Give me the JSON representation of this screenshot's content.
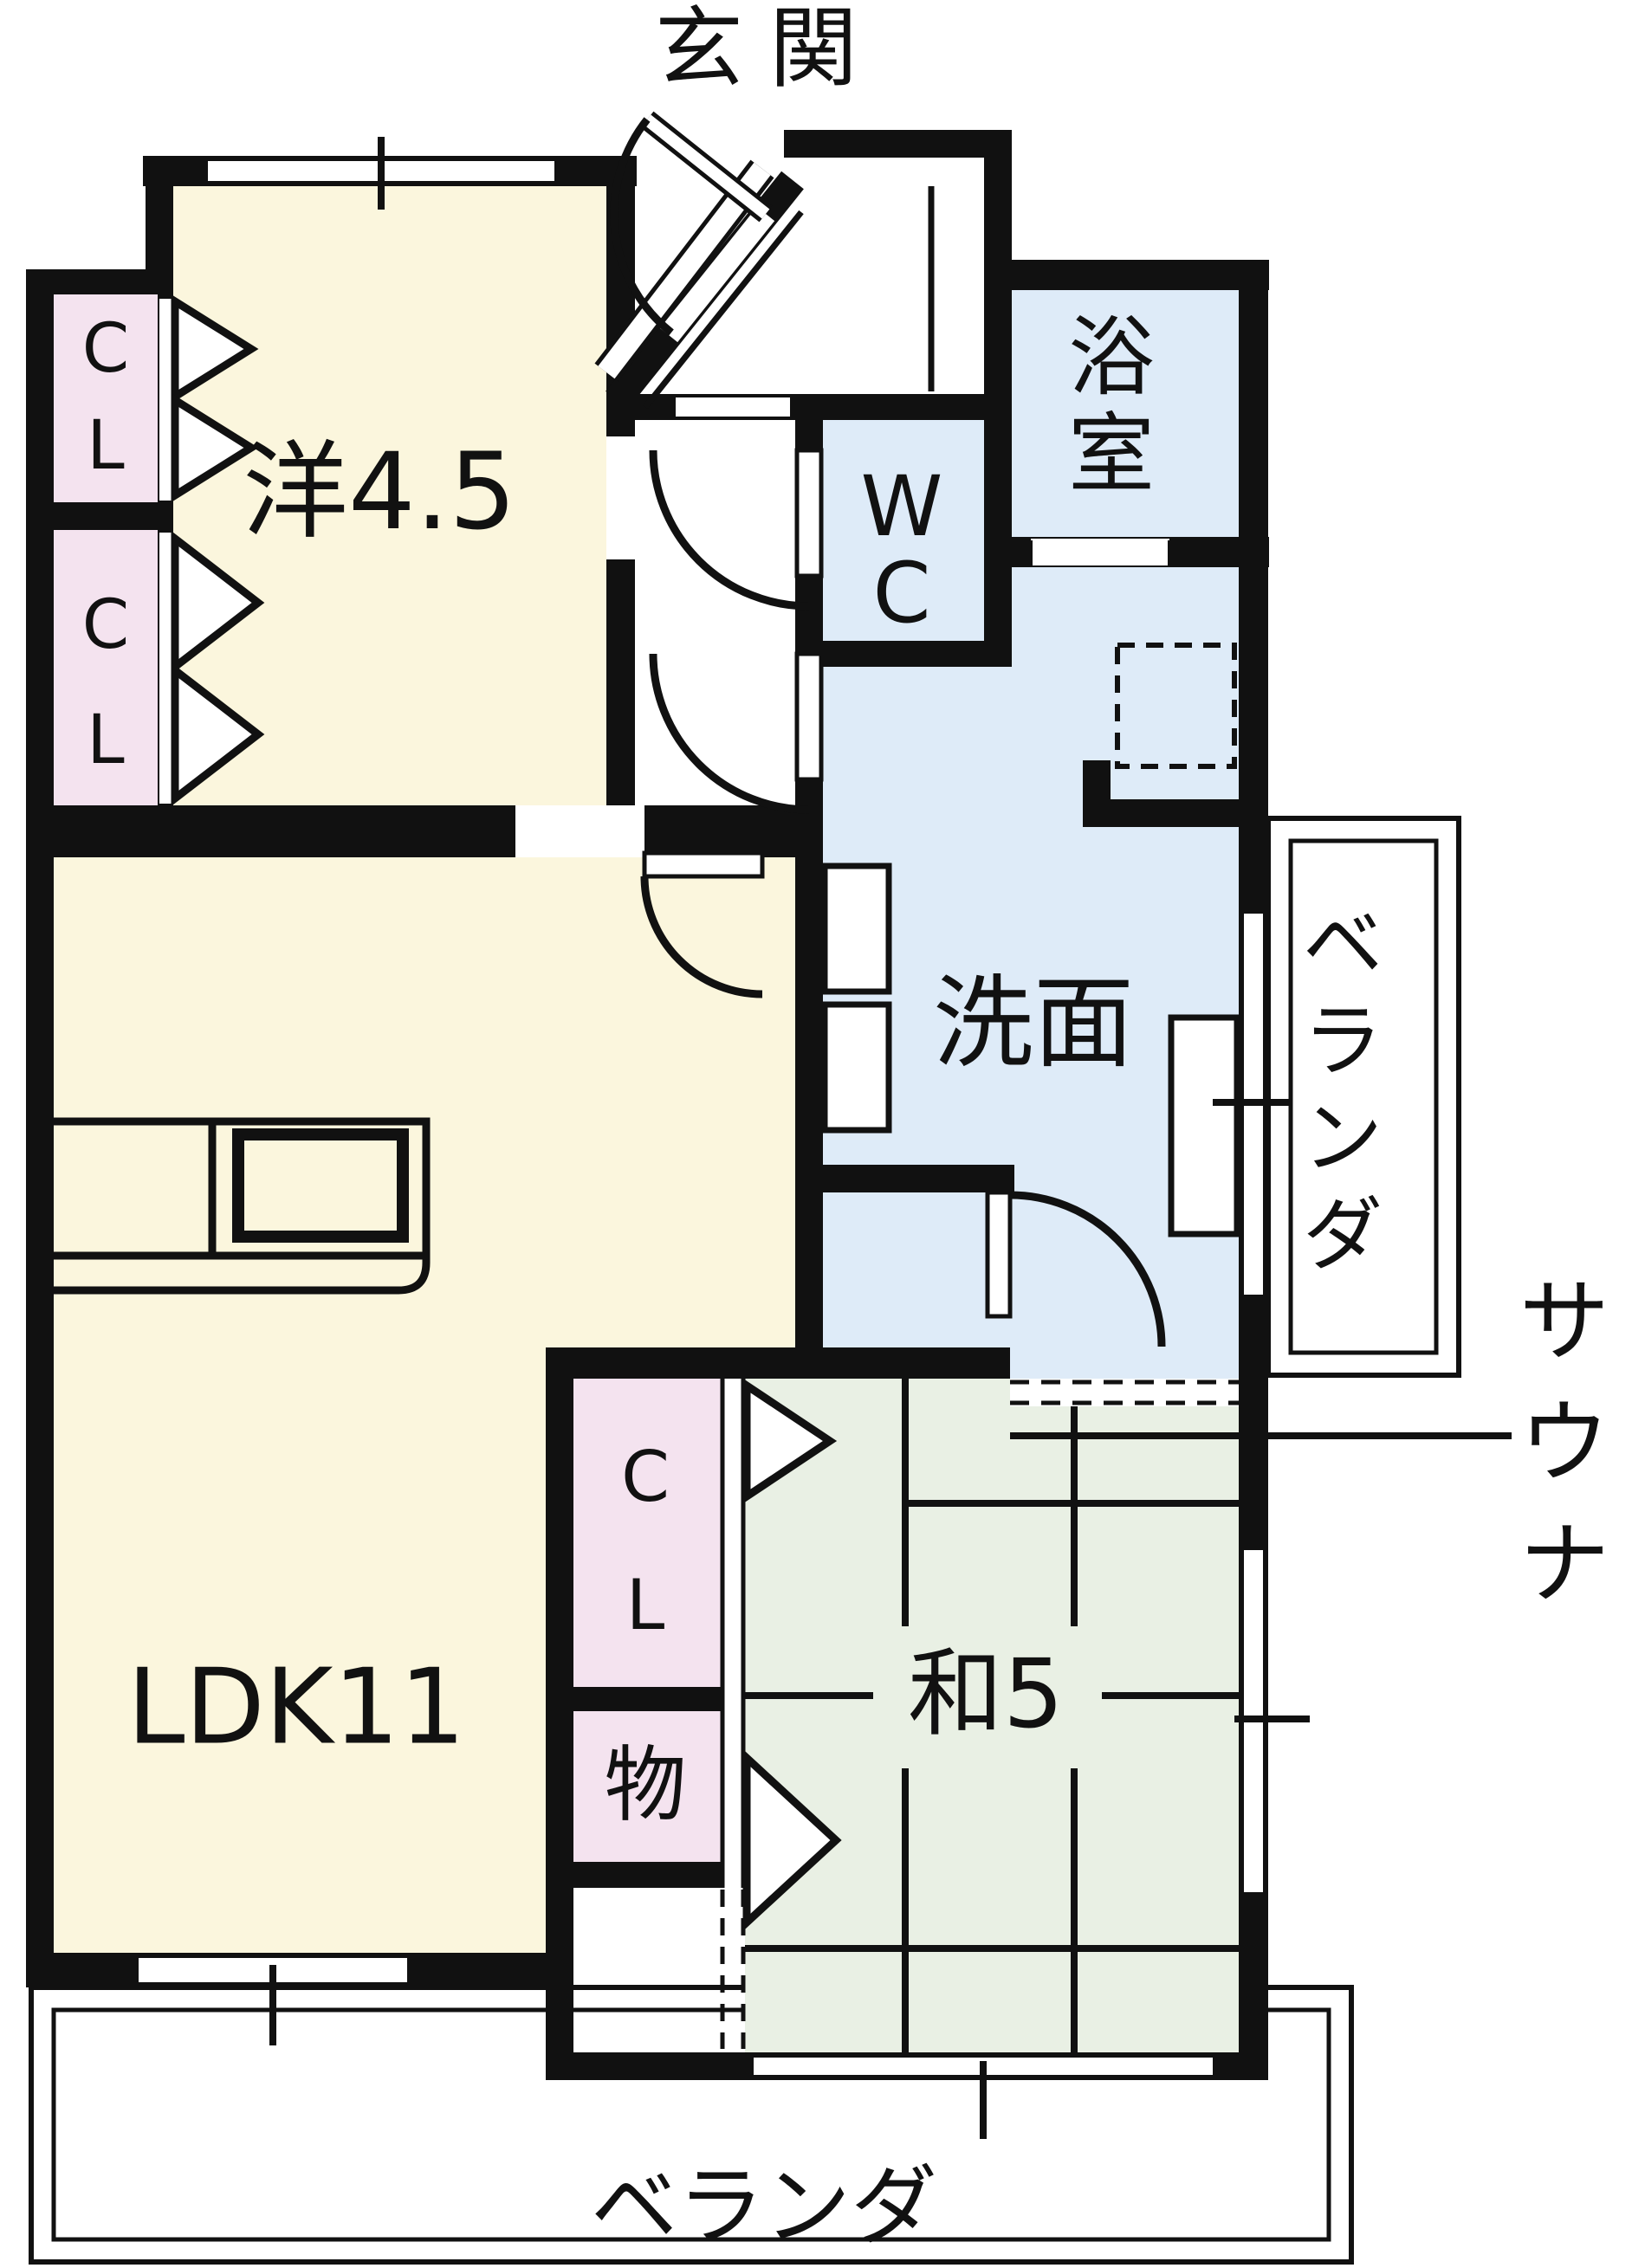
{
  "floor_plan": {
    "kind": "apartment-floor-plan",
    "rooms": [
      {
        "name": "entrance",
        "label": "玄関"
      },
      {
        "name": "western-room",
        "label": "洋4.5"
      },
      {
        "name": "closet-upper-1",
        "label": "CL"
      },
      {
        "name": "closet-upper-2",
        "label": "CL"
      },
      {
        "name": "wc",
        "label": "WC"
      },
      {
        "name": "bathroom",
        "label": "浴室"
      },
      {
        "name": "washroom",
        "label": "洗面"
      },
      {
        "name": "sauna",
        "label": "サウナ"
      },
      {
        "name": "ldk",
        "label": "LDK11"
      },
      {
        "name": "japanese-room",
        "label": "和5"
      },
      {
        "name": "closet-lower",
        "label": "CL"
      },
      {
        "name": "storage",
        "label": "物"
      },
      {
        "name": "veranda-right",
        "label": "ベランダ"
      },
      {
        "name": "veranda-bottom",
        "label": "ベランダ"
      }
    ],
    "colors": {
      "wall": "#111111",
      "background": "#ffffff",
      "yellow_room_fill": "#FBF6DD",
      "closet_fill": "#F4E3EF",
      "wet_area_fill": "#DEEBF8",
      "tatami_fill": "#E9F0E4"
    }
  }
}
